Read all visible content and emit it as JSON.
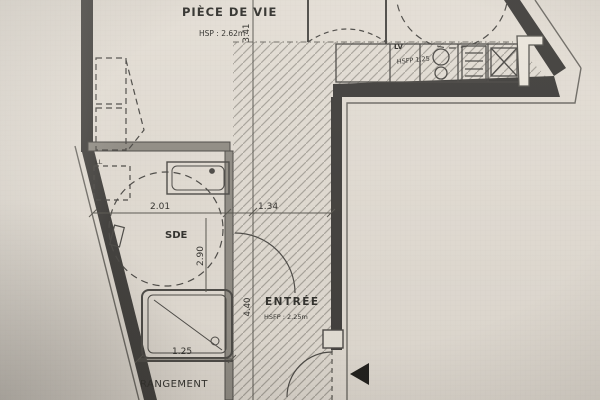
{
  "photo": {
    "description": "Photo d'un plan d'architecte - studio"
  },
  "rooms": {
    "piece_de_vie": {
      "name": "PIÈCE DE VIE",
      "ceiling_height": "HSP : 2.62m"
    },
    "sde": {
      "name": "SDE"
    },
    "entree": {
      "name": "ENTRÉE",
      "ceiling_height": "HSFP : 2.25m"
    },
    "rangement": {
      "name": "RANGEMENT"
    },
    "cuisine": {
      "dishwasher": "LV",
      "ceiling_height": "HSFP 1.25",
      "washer": "LL"
    }
  },
  "dimensions": {
    "upper_depth": "3.41",
    "sde_width": "2.01",
    "hall_width": "1.34",
    "sde_depth": "2.90",
    "entree_depth": "4.40",
    "rangement_width": "1.25"
  },
  "colors": {
    "paper": "#d9d6d1",
    "wall": "#3f3e3c",
    "line": "#4a4846",
    "hatch": "#96938e",
    "text": "#2f2e2b"
  }
}
